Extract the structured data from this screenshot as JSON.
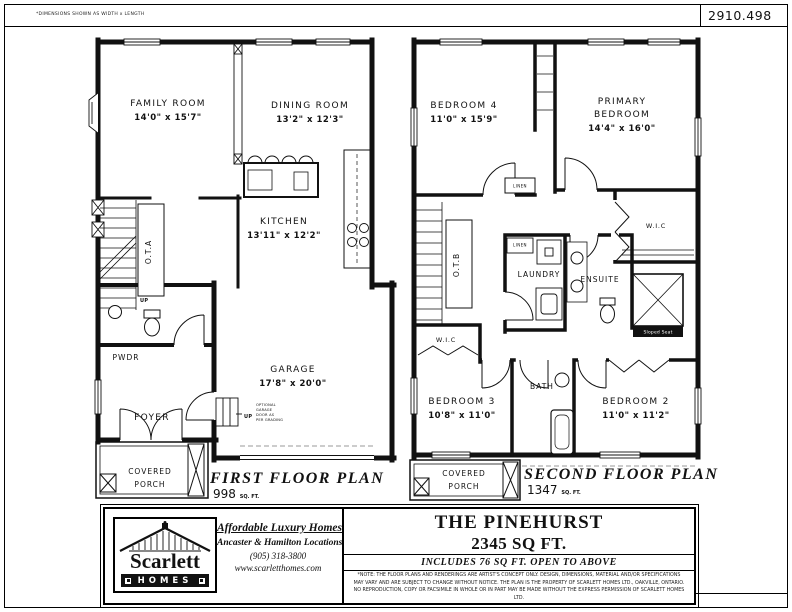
{
  "colors": {
    "ink": "#111111",
    "paper": "#ffffff",
    "muted": "#999999"
  },
  "header": {
    "note": "*DIMENSIONS SHOWN AS WIDTH x LENGTH",
    "drawing_number": "2910.498"
  },
  "first_floor": {
    "title": "FIRST FLOOR PLAN",
    "area_value": "998",
    "area_unit": "SQ. FT.",
    "rooms": {
      "family": {
        "name": "FAMILY ROOM",
        "dims": "14'0\" x 15'7\""
      },
      "dining": {
        "name": "DINING ROOM",
        "dims": "13'2\" x 12'3\""
      },
      "kitchen": {
        "name": "KITCHEN",
        "dims": "13'11\" x 12'2\""
      },
      "garage": {
        "name": "GARAGE",
        "dims": "17'8\" x 20'0\""
      },
      "foyer": "FOYER",
      "powder": "PWDR",
      "ota": "O.T.A",
      "porch_line1": "COVERED",
      "porch_line2": "PORCH"
    },
    "notes": {
      "up_stairs": "UP",
      "up_garage": "UP",
      "garage_note1": "OPTIONAL",
      "garage_note2": "GARAGE",
      "garage_note3": "DOOR AS",
      "garage_note4": "PER GRADING"
    }
  },
  "second_floor": {
    "title": "SECOND FLOOR PLAN",
    "area_value": "1347",
    "area_unit": "SQ. FT.",
    "rooms": {
      "bedroom4": {
        "name": "BEDROOM 4",
        "dims": "11'0\" x 15'9\""
      },
      "primary": {
        "line1": "PRIMARY",
        "line2": "BEDROOM",
        "dims": "14'4\" x 16'0\""
      },
      "bedroom3": {
        "name": "BEDROOM 3",
        "dims": "10'8\" x 11'0\""
      },
      "bedroom2": {
        "name": "BEDROOM 2",
        "dims": "11'0\" x 11'2\""
      },
      "wic_primary": "W.I.C",
      "wic_bedroom3": "W.I.C",
      "laundry": "LAUNDRY",
      "ensuite": "ENSUITE",
      "bath": "BATH",
      "otb": "O.T.B",
      "linen_hall": "LINEN",
      "linen_laundry": "LINEN",
      "sloped_seat": "Sloped Seat",
      "porch_line1": "COVERED",
      "porch_line2": "PORCH"
    }
  },
  "title_block": {
    "logo": {
      "brand": "Scarlett",
      "homes": "HOMES"
    },
    "tagline": "Affordable Luxury Homes",
    "locations": "Ancaster & Hamilton Locations",
    "phone": "(905) 318-3800",
    "website": "www.scarletthomes.com",
    "model_name": "THE PINEHURST",
    "model_area": "2345 SQ FT.",
    "model_note": "INCLUDES 76 SQ FT. OPEN TO ABOVE",
    "disclaimer": "*NOTE: THE FLOOR PLANS AND RENDERINGS ARE ARTIST'S CONCEPT ONLY. DESIGN, DIMENSIONS, MATERIAL AND/OR SPECIFICATIONS MAY VARY AND ARE SUBJECT TO CHANGE WITHOUT NOTICE. THE PLAN IS THE PROPERTY OF SCARLETT HOMES LTD., OAKVILLE, ONTARIO. NO REPRODUCTION, COPY OR FACSIMILE IN WHOLE OR IN PART MAY BE MADE WITHOUT THE EXPRESS PERMISSION OF SCARLETT HOMES LTD."
  }
}
